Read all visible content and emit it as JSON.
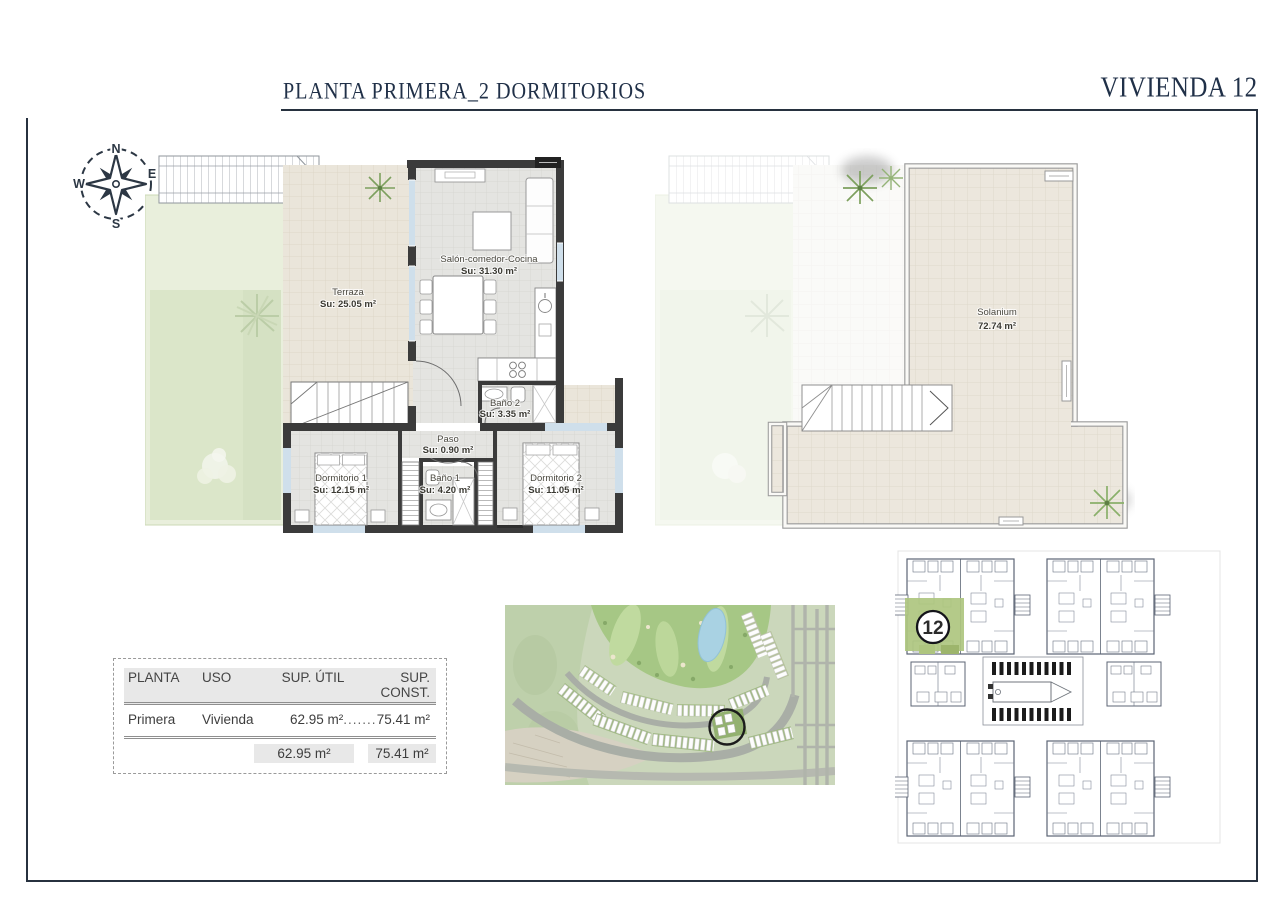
{
  "header": {
    "title": "PLANTA PRIMERA_2 DORMITORIOS",
    "unit": "VIVIENDA 12"
  },
  "compass": {
    "north": "N",
    "east": "E",
    "south": "S",
    "west": "W"
  },
  "floor_plan": {
    "terraza": {
      "name": "Terraza",
      "area": "Su: 25.05 m²"
    },
    "salon": {
      "name": "Salón-comedor-Cocina",
      "area": "Su: 31.30 m²"
    },
    "bano2": {
      "name": "Baño 2",
      "area": "Su: 3.35 m²"
    },
    "paso": {
      "name": "Paso",
      "area": "Su: 0.90 m²"
    },
    "dormitorio1": {
      "name": "Dormitorio 1",
      "area": "Su: 12.15 m²"
    },
    "bano1": {
      "name": "Baño 1",
      "area": "Su: 4.20 m²"
    },
    "dormitorio2": {
      "name": "Dormitorio 2",
      "area": "Su: 11.05 m²"
    }
  },
  "solarium_plan": {
    "name": "Solanium",
    "area": "72.74 m²"
  },
  "areas_table": {
    "headers": [
      "PLANTA",
      "USO",
      "SUP. ÚTIL",
      "SUP. CONST."
    ],
    "row": {
      "planta": "Primera",
      "uso": "Vivienda",
      "sup_util": "62.95 m²",
      "leader": "...............",
      "sup_const": "75.41 m²"
    },
    "totals": {
      "sup_util": "62.95 m²",
      "sup_const": "75.41 m²"
    }
  },
  "site_plan": {
    "unit_number": "12"
  },
  "colors": {
    "accent_navy": "#27313f",
    "wall_dark": "#3b3b3b",
    "highlight_green": "#aec57f",
    "garden_green": "#dbe6c9",
    "tile_beige": "#eae5da"
  }
}
